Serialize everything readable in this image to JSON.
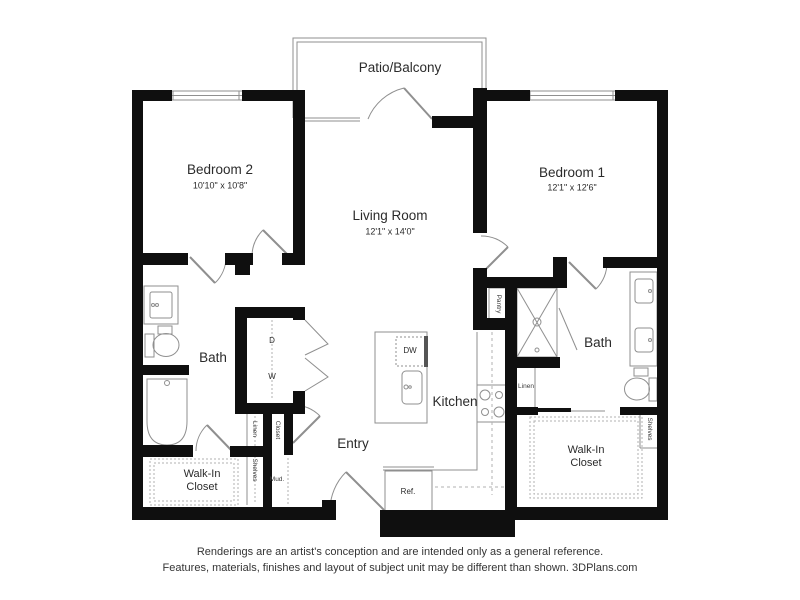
{
  "colors": {
    "wall": "#0f0f0f",
    "line": "#8f8f8f",
    "dash": "#b0b0b0",
    "text": "#2b2b2b"
  },
  "rooms": {
    "patio": {
      "name": "Patio/Balcony"
    },
    "bedroom2": {
      "name": "Bedroom 2",
      "dims": "10'10\" x 10'8\""
    },
    "bedroom1": {
      "name": "Bedroom 1",
      "dims": "12'1\" x 12'6\""
    },
    "living_room": {
      "name": "Living Room",
      "dims": "12'1\" x 14'0\""
    },
    "kitchen": {
      "name": "Kitchen"
    },
    "entry": {
      "name": "Entry"
    },
    "bath_left": {
      "name": "Bath"
    },
    "bath_right": {
      "name": "Bath"
    },
    "walkin_closet_left": {
      "name": "Walk-In Closet"
    },
    "walkin_closet_right": {
      "name": "Walk-In Closet"
    }
  },
  "labels": {
    "dryer": "D",
    "washer": "W",
    "dishwasher": "DW",
    "refrigerator": "Ref.",
    "pantry": "Pantry",
    "linen_left": "Linen",
    "linen_right": "Linen",
    "closet": "Closet",
    "shelves_left": "Shelves",
    "shelves_right": "Shelves",
    "mud": "Mud."
  },
  "footer": {
    "line1": "Renderings are an artist's conception and are intended only as a general reference.",
    "line2": "Features, materials, finishes and layout of subject unit may be different than shown. 3DPlans.com"
  }
}
